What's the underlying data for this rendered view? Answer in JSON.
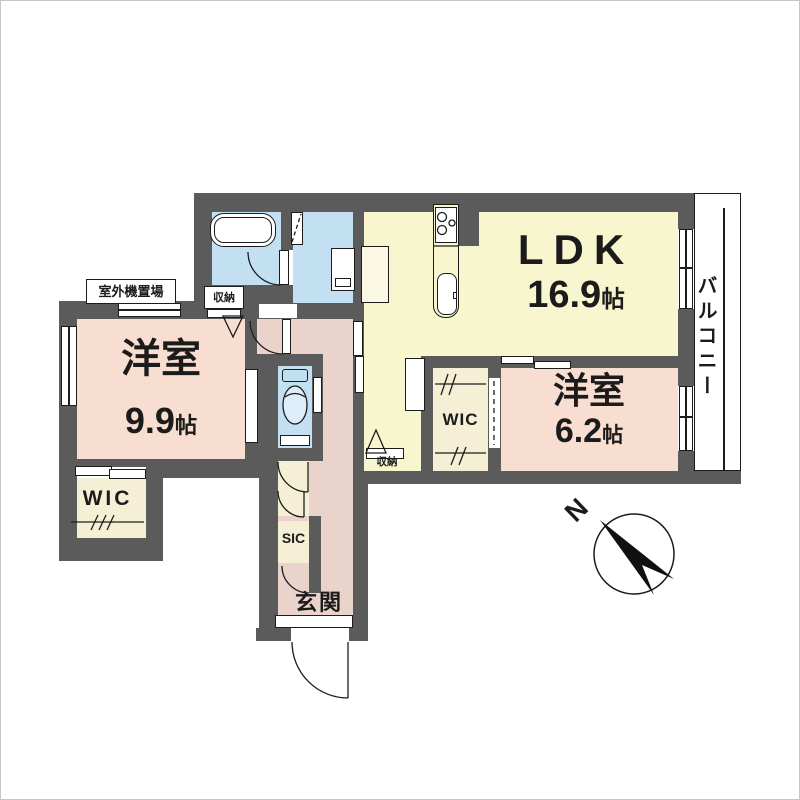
{
  "rooms": {
    "ldk": {
      "name": "LDK",
      "size": "16.9",
      "unit": "帖"
    },
    "bedroom_main": {
      "name": "洋室",
      "size": "9.9",
      "unit": "帖"
    },
    "bedroom_second": {
      "name": "洋室",
      "size": "6.2",
      "unit": "帖"
    },
    "wic_main": {
      "label": "WIC"
    },
    "wic_second": {
      "label": "WIC"
    },
    "sic": {
      "label": "SIC"
    },
    "entrance": {
      "label": "玄関"
    },
    "balcony": {
      "label": "バルコニー"
    },
    "outdoor_unit_area": {
      "label": "室外機置場"
    },
    "storage_bath": {
      "label": "収納"
    },
    "storage_ldk": {
      "label": "収納"
    }
  },
  "compass": {
    "north_label": "N"
  },
  "colors": {
    "wall": "#5c5b5b",
    "room_pink": "#f8ddd1",
    "hall_pink": "#e9d3ca",
    "ldk_yellow": "#f8f6ce",
    "wet_blue": "#c3e0f2",
    "closet_cream": "#f5efd6",
    "outline": "#1c1c1c"
  }
}
